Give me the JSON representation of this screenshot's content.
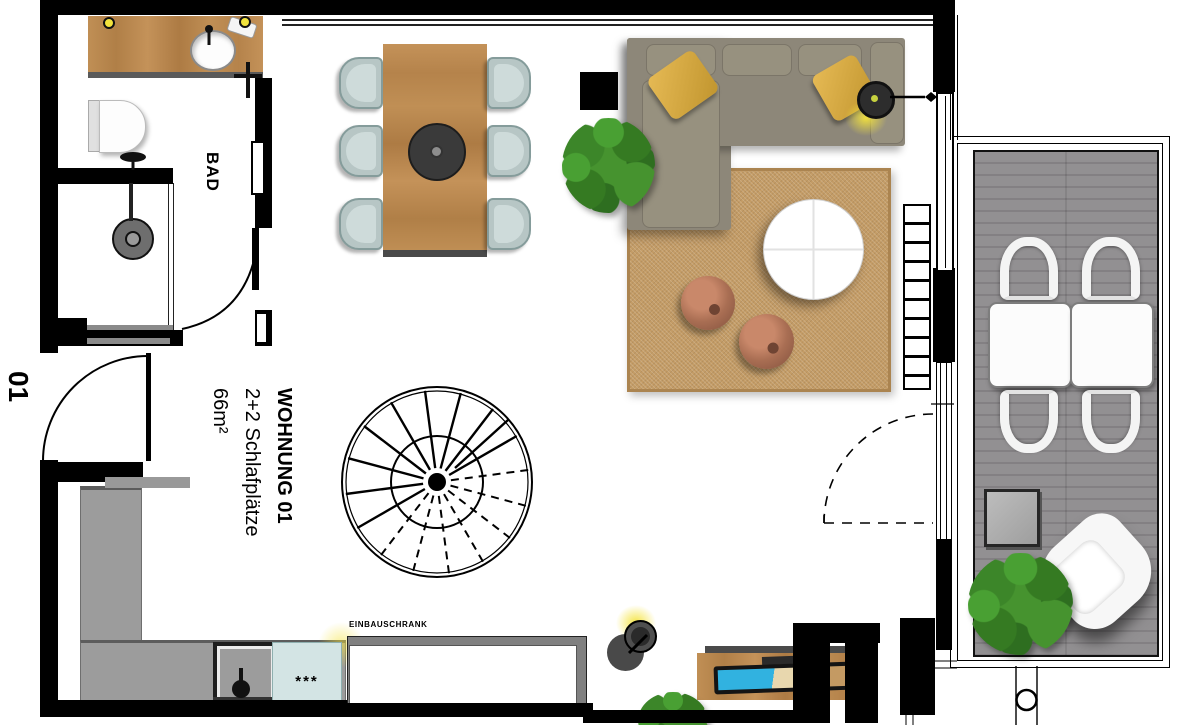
{
  "floor_plan": {
    "unit_label": "01",
    "apartment": {
      "name": "WOHNUNG 01",
      "capacity": "2+2 Schlafplätze",
      "area": "66m²"
    },
    "rooms": {
      "bathroom_label": "BAD"
    },
    "fixtures": {
      "builtin_closet_label": "EINBAUSCHRANK",
      "appliance_stars": "***"
    }
  },
  "colors": {
    "wall": "#000000",
    "wood": "#b98a52",
    "rug": "#c49c66",
    "sofa": "#8d8779",
    "pillow": "#ddb04a",
    "dining_chair": "#b7c6c5",
    "balcony_deck": "#8b888b",
    "kitchen_counter": "#9c9c9c",
    "cooktop": "#d3e4e4",
    "lamp_glow": "#f2e33c",
    "plant": "#3c8629",
    "pouf": "#a96e53"
  }
}
